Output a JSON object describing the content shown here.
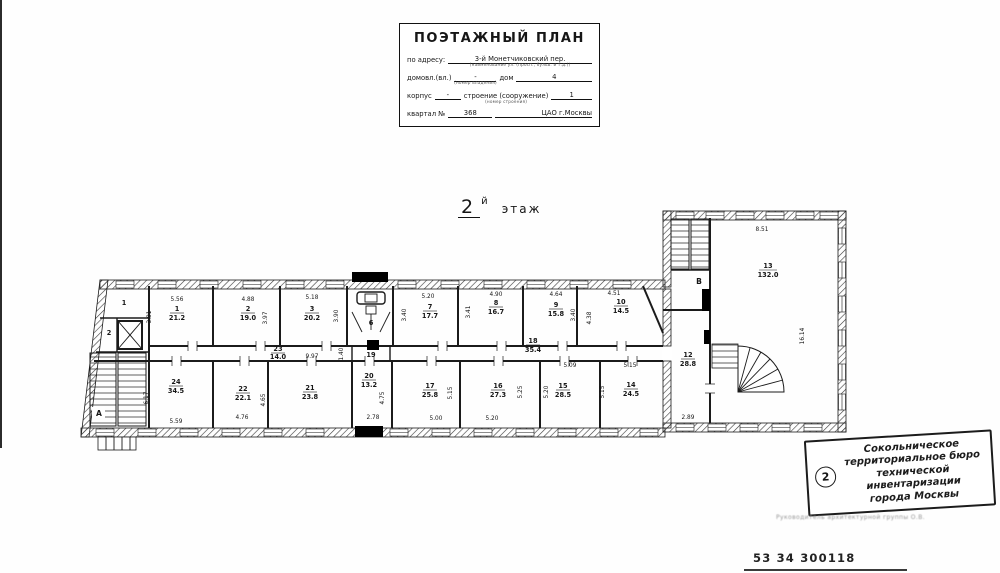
{
  "title_block": {
    "title": "ПОЭТАЖНЫЙ ПЛАН",
    "address_label": "по адресу:",
    "address_value": "3-й Монетчиковский пер.",
    "address_note": "(наименование ул. (просп., бульв. и т.д.))",
    "vl_label": "домовл.(вл.)",
    "vl_value": "-",
    "vl_note": "(номер владения)",
    "house_label": "дом",
    "house_value": "4",
    "korpus_label": "корпус",
    "korpus_value": "-",
    "stroenie_label": "строение (сооружение)",
    "stroenie_note": "(номер строения)",
    "stroenie_value": "1",
    "kvartal_label": "квартал №",
    "kvartal_value": "368",
    "district": "ЦАО г.Москвы"
  },
  "floor_label": {
    "number": "2",
    "suffix": "й",
    "word": "этаж"
  },
  "plan": {
    "rooms": [
      {
        "n": "1",
        "a": "21.2",
        "w": "5.56",
        "h": "3.81"
      },
      {
        "n": "2",
        "a": "19.0",
        "w": "4.88",
        "h": "3.97"
      },
      {
        "n": "3",
        "a": "20.2",
        "w": "5.18",
        "h": "3.90"
      },
      {
        "n": "7",
        "a": "17.7",
        "w": "5.20",
        "h": "3.40"
      },
      {
        "n": "8",
        "a": "16.7",
        "w": "4.90",
        "h": "3.41"
      },
      {
        "n": "9",
        "a": "15.8",
        "w": "4.64",
        "h": "3.40"
      },
      {
        "n": "10",
        "a": "14.5",
        "w": "4.51",
        "h": "4.38"
      },
      {
        "n": "23",
        "a": "14.0",
        "w": "9.97",
        "h": "1.40"
      },
      {
        "n": "18",
        "a": "35.4"
      },
      {
        "n": "24",
        "a": "34.5",
        "w": "5.59",
        "h": "6.17"
      },
      {
        "n": "22",
        "a": "22.1",
        "w": "4.76",
        "h": "4.65"
      },
      {
        "n": "21",
        "a": "23.8"
      },
      {
        "n": "20",
        "a": "13.2",
        "w": "2.78",
        "h": "4.75"
      },
      {
        "n": "17",
        "a": "25.8",
        "w": "5.00",
        "h": "5.15"
      },
      {
        "n": "16",
        "a": "27.3",
        "w": "5.20",
        "h": "5.25"
      },
      {
        "n": "15",
        "a": "28.5",
        "w": "5.09",
        "h": "5.20"
      },
      {
        "n": "14",
        "a": "24.5",
        "w": "5.15",
        "h": "5.15"
      },
      {
        "n": "12",
        "a": "28.8",
        "w": "2.89"
      },
      {
        "n": "13",
        "a": "132.0",
        "w": "8.51",
        "h": "16.14"
      },
      {
        "n": "6"
      },
      {
        "n": "19"
      }
    ],
    "stair_a": "А",
    "stair_b": "В",
    "aux_1": "1",
    "aux_2": "2"
  },
  "stamp": {
    "badge": "2",
    "lines": [
      "Сокольническое",
      "территориальное бюро",
      "технической инвентаризации",
      "города Москвы"
    ]
  },
  "footer": {
    "signature": "Руководитель архитектурной группы О.В.",
    "doc_number": "53 34 300118"
  }
}
